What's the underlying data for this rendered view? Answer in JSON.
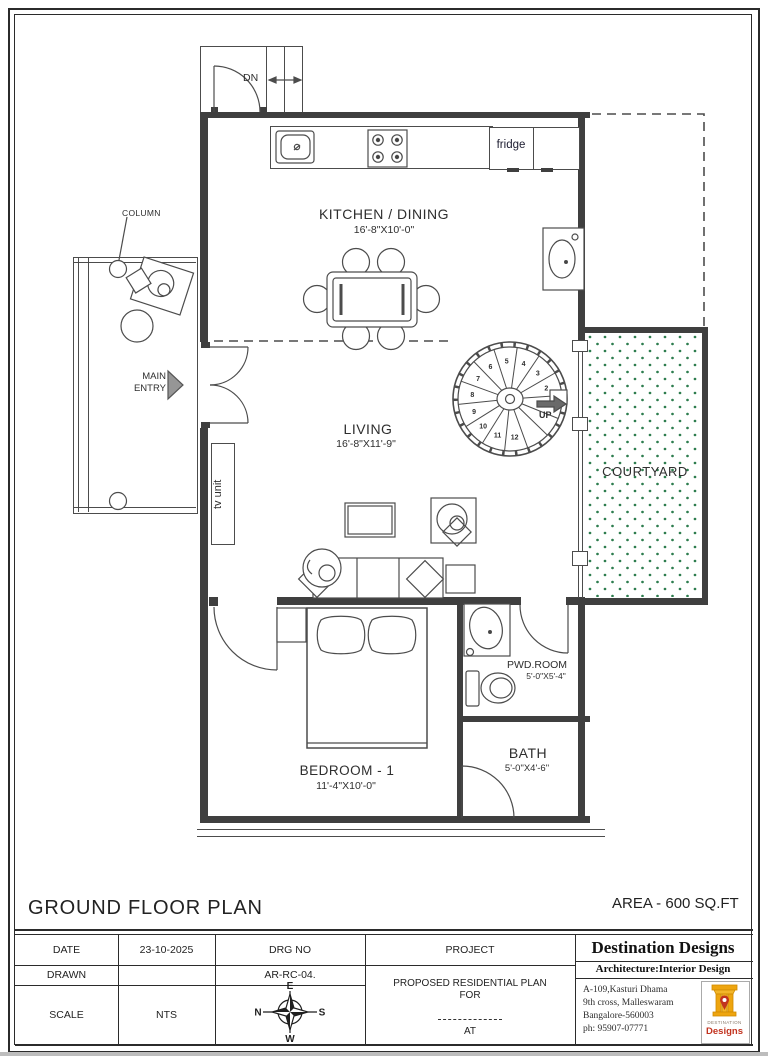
{
  "plan": {
    "dn_label": "DN",
    "column_label": "COLUMN",
    "main_entry_line1": "MAIN",
    "main_entry_line2": "ENTRY",
    "fridge_label": "fridge",
    "tv_unit_label": "tv unit",
    "up_label": "UP",
    "rooms": {
      "kitchen": {
        "name": "KITCHEN / DINING",
        "dim": "16'-8\"X10'-0\""
      },
      "living": {
        "name": "LIVING",
        "dim": "16'-8\"X11'-9\""
      },
      "courtyard": {
        "name": "COURTYARD"
      },
      "bedroom": {
        "name": "BEDROOM - 1",
        "dim": "11'-4\"X10'-0\""
      },
      "pwd": {
        "name": "PWD.ROOM",
        "dim": "5'-0\"X5'-4\""
      },
      "bath": {
        "name": "BATH",
        "dim": "5'-0\"X4'-6\""
      }
    },
    "stairs": {
      "numbers": [
        "1",
        "2",
        "3",
        "4",
        "5",
        "6",
        "7",
        "8",
        "9",
        "10",
        "11",
        "12"
      ]
    },
    "colors": {
      "wall": "#3f3f3f",
      "courtyard_dot": "#2e7d4f",
      "logo_yellow": "#eea50f",
      "logo_red": "#c2331f"
    }
  },
  "footer": {
    "plan_title": "GROUND FLOOR PLAN",
    "area_label": "AREA - 600 SQ.FT",
    "table": {
      "date_label": "DATE",
      "date_value": "23-10-2025",
      "drg_no_label": "DRG NO",
      "drg_no_value": "AR-RC-04.",
      "drawn_label": "DRAWN",
      "scale_label": "SCALE",
      "scale_value": "NTS",
      "project_label": "PROJECT",
      "project_line1": "PROPOSED RESIDENTIAL PLAN",
      "project_line2": "FOR",
      "project_line3": "AT"
    },
    "compass": {
      "north": "N",
      "east": "E",
      "south": "S",
      "west": "W"
    },
    "firm": {
      "name": "Destination Designs",
      "tagline": "Architecture:Interior  Design",
      "address_line1": "A-109,Kasturi Dhama",
      "address_line2": "9th cross, Malleswaram",
      "address_line3": "Bangalore-560003",
      "address_line4": "ph: 95907-07771",
      "logo_text_top": "DESTINATION",
      "logo_text_bottom": "Designs"
    }
  }
}
